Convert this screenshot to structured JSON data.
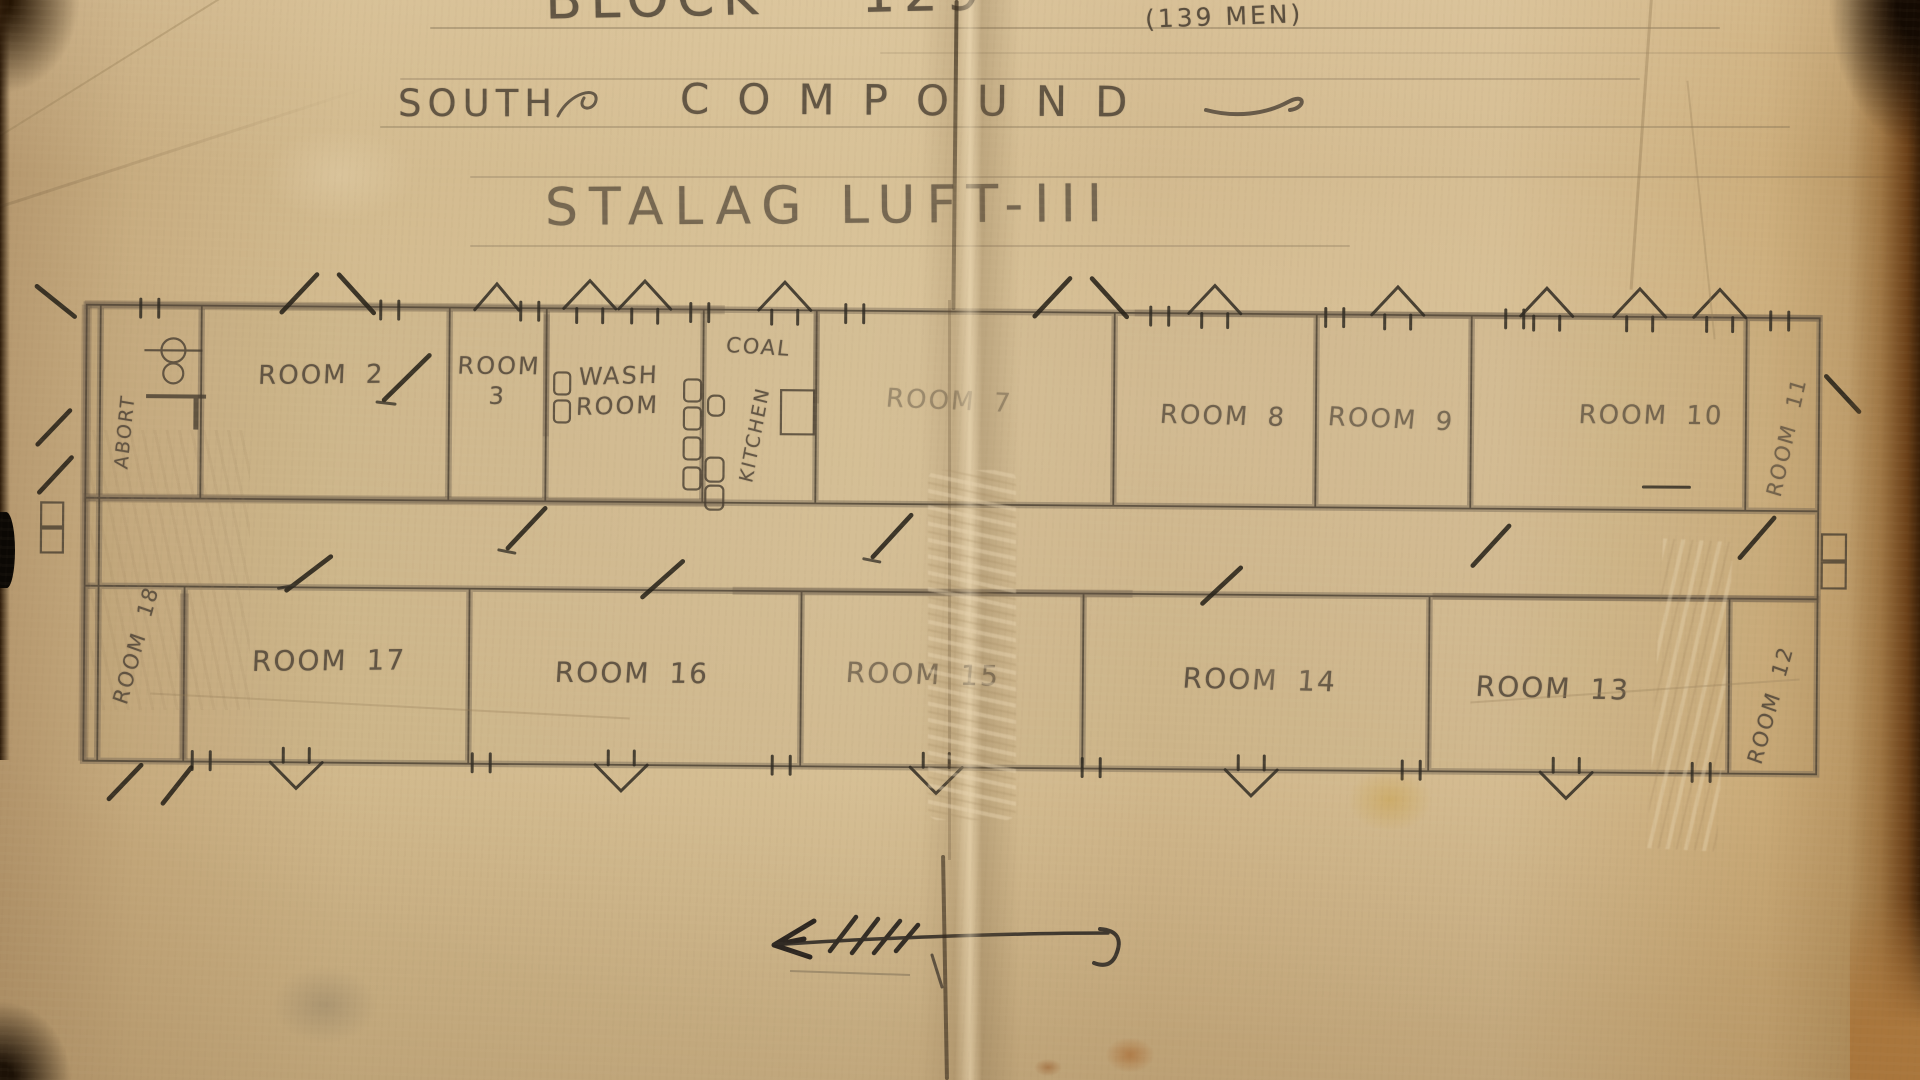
{
  "document": {
    "block_title": "BLOCK 129",
    "capacity": "(139 MEN)",
    "compound_word_1": "SOUTH",
    "compound_word_2": "COMPOUND",
    "camp_title": "STALAG LUFT-III"
  },
  "floor_plan": {
    "top_row": [
      {
        "label": "ABORT"
      },
      {
        "label": "ROOM 2"
      },
      {
        "label": "ROOM 3"
      },
      {
        "label": "WASH ROOM"
      },
      {
        "label": "COAL"
      },
      {
        "label": "KITCHEN"
      },
      {
        "label": "ROOM 7"
      },
      {
        "label": "ROOM 8"
      },
      {
        "label": "ROOM 9"
      },
      {
        "label": "ROOM 10"
      },
      {
        "label": "ROOM 11"
      }
    ],
    "bottom_row": [
      {
        "label": "ROOM 18"
      },
      {
        "label": "ROOM 17"
      },
      {
        "label": "ROOM 16"
      },
      {
        "label": "ROOM 15"
      },
      {
        "label": "ROOM 14"
      },
      {
        "label": "ROOM 13"
      },
      {
        "label": "ROOM 12"
      }
    ]
  },
  "colors": {
    "paper": "#cfb488",
    "pencil_dark": "#36302a",
    "pencil_mid": "#4e4336",
    "pencil_soft": "#6e6150",
    "photo_border_brown": "#6b4018"
  }
}
